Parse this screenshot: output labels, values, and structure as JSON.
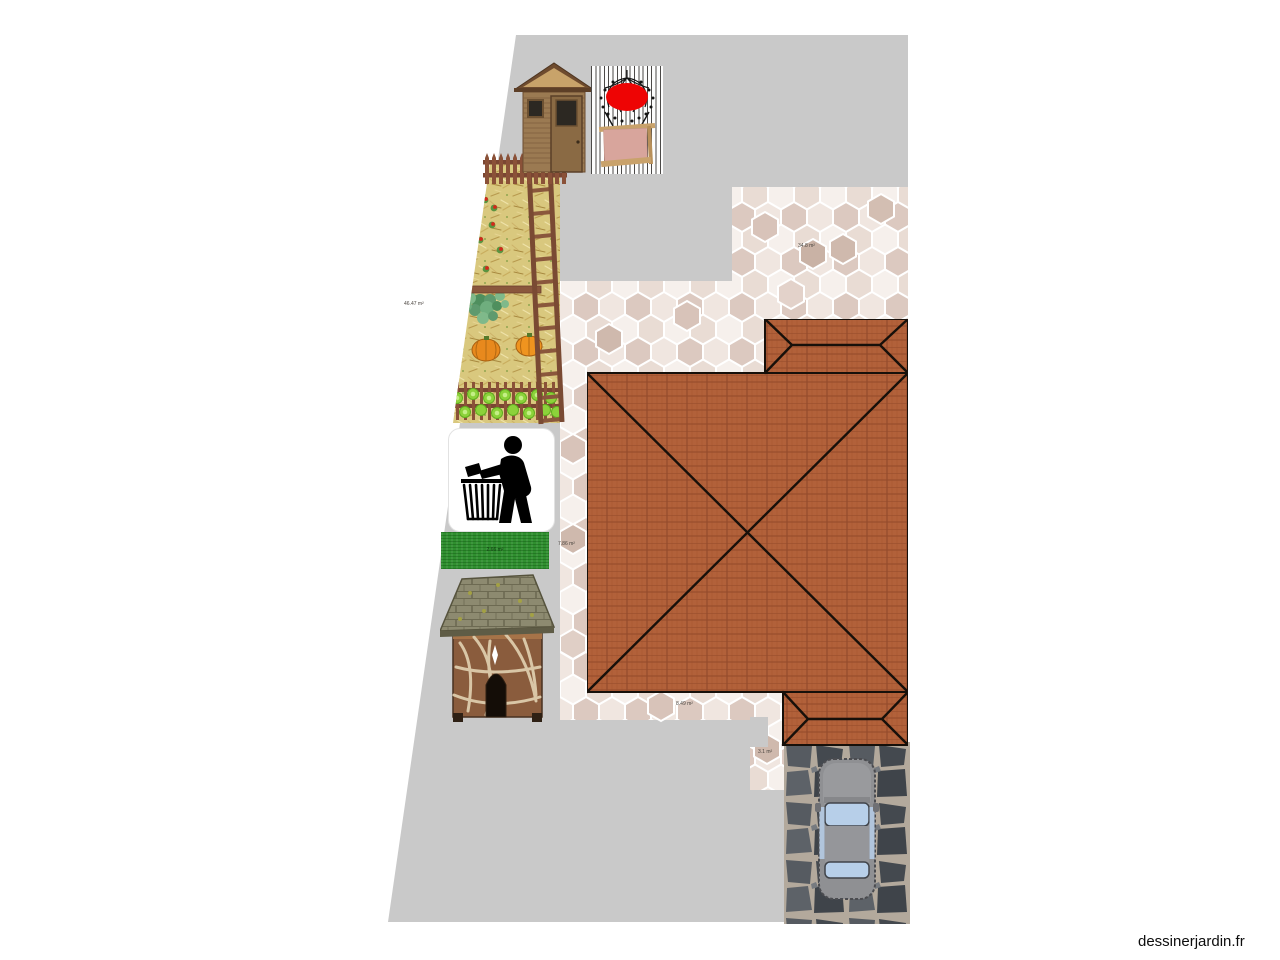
{
  "watermark": "dessinerjardin.fr",
  "labels": {
    "garden_area": "46.47 m²",
    "patio_top_area": "34.8 m²",
    "patio_left_area": "7.86 m²",
    "patio_bottom_area": "8.49 m²",
    "patio_tab_area": "3.1 m²",
    "lawn_area": "2.66 m²"
  },
  "icons": {
    "litter_sign": "tidyman-person-dropping-litter-into-basket"
  },
  "colors": {
    "plot_gray": "#c9c9c9",
    "tile_light": "#f6f0ec",
    "tile_dark": "#cdb5aa",
    "roof_terracotta": "#b2613a",
    "roof_ridge": "#17100a",
    "lawn_green": "#2f8f2f",
    "portal_red": "#ee0404",
    "portal_pink": "#d8a59c",
    "driveway_base": "#b3a99c",
    "driveway_stone": "#4a4f55",
    "car_body": "#97989b",
    "car_glass": "#b7cfe9",
    "wood_brown": "#8a5c3d",
    "straw_yellow": "#d9c87e"
  }
}
